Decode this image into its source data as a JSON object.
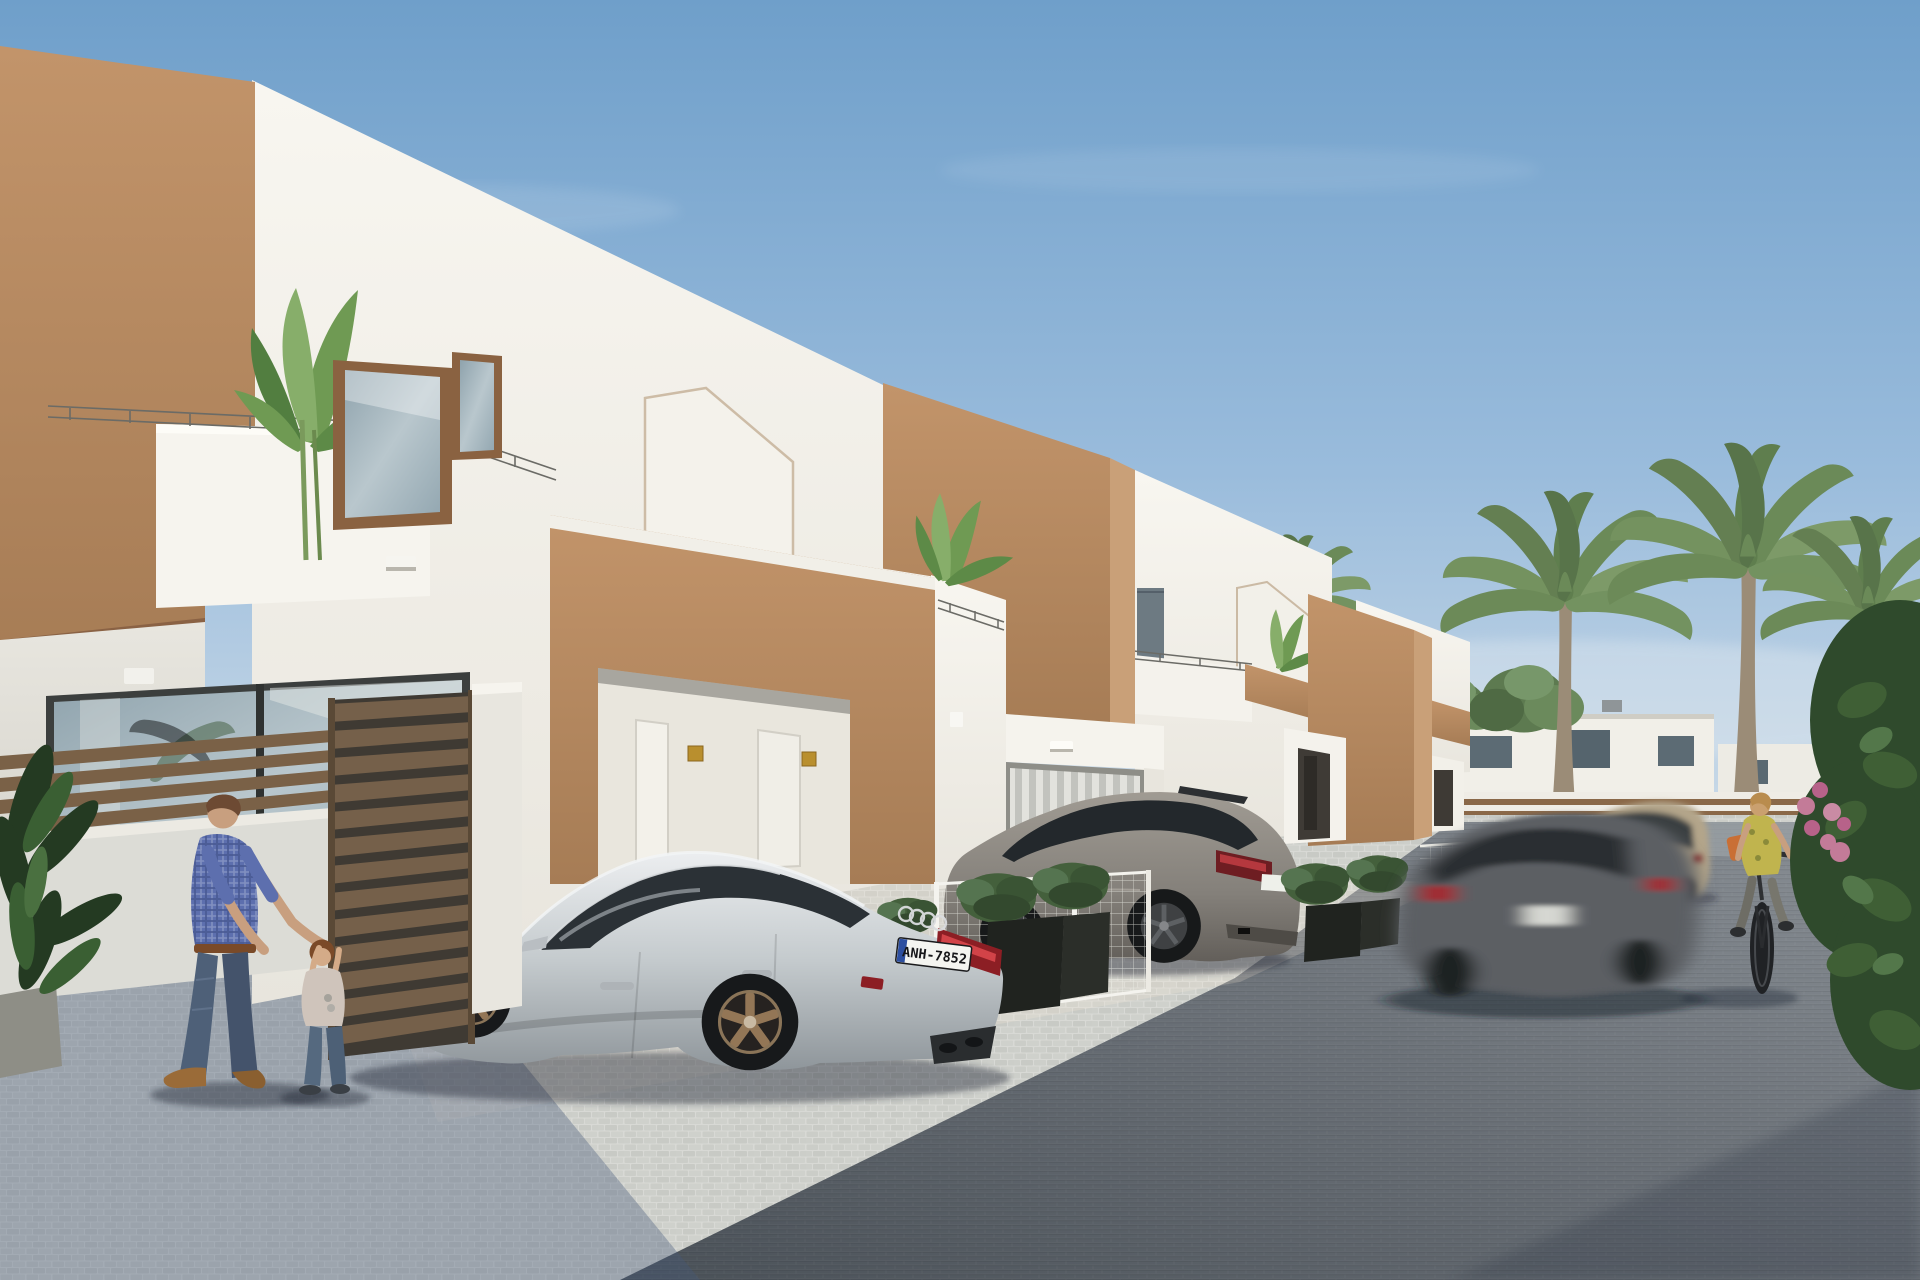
{
  "meta": {
    "title": "New-build Mediterranean villas — exterior street 3D render",
    "type": "photorealistic architectural visualization",
    "time_of_day": "daytime, clear blue sky"
  },
  "palette": {
    "sky-top": "#6f9fca",
    "sky-mid": "#9abcdc",
    "sky-horizon": "#cfdde9",
    "wall-white": "#f6f4ee",
    "wall-white-dim": "#e9e6de",
    "wall-shade": "#dcdad2",
    "brown": "#b78a61",
    "brown-light": "#c9a078",
    "brown-dark": "#9c7351",
    "brown-recess": "#8a6244",
    "frame-brown": "#8a6241",
    "glass-blue": "#a9bfcc",
    "glass-dark": "#2e3438",
    "railing": "#6b6b66",
    "fence-brown": "#7a6147",
    "gate-brown": "#6e5841",
    "cobble": "#d2d3d0",
    "cobble-shade": "#8fa0b5",
    "asphalt": "#6a7076",
    "asphalt-dark": "#4d545c",
    "asphalt-light": "#9aa0a4",
    "planter": "#20231f",
    "shrub-green": "#44603c",
    "palm-green": "#7d9a68",
    "palm-trunk": "#9b8c77",
    "foliage-dark": "#2f4a2c",
    "flower-pink": "#c37b98",
    "audi-silver": "#ccd1d4",
    "audi-shadow": "#9aa1a7",
    "wheel-bronze": "#937656",
    "tire": "#17191b",
    "tail-red": "#8c1e24",
    "tail-red-bright": "#cf4348",
    "mazda-gray": "#8b8781",
    "suv-beige": "#b3a58a",
    "blur-gray": "#5b5f63",
    "plate-bg": "#f4f4f0",
    "plate-text": "#17171a",
    "skin": "#c89f7f",
    "hair-brown": "#6d4a33",
    "shirt-plaid-blue": "#5d6fae",
    "jeans": "#4e6078",
    "shoe-brown": "#9a6b38",
    "child-shirt": "#cfc4bb",
    "cyclist-top": "#c0b44e",
    "cyclist-pants": "#6e6d65",
    "bag-orange": "#c96f35",
    "lamp-white": "#fdfcf8",
    "plaque-gold": "#b98f2e"
  },
  "scene": {
    "setting": "street of new-build two-storey white villas with tan-brown accent volumes, palm trees, parked cars and people",
    "villas": {
      "count": 4,
      "features": [
        "white stucco volumes",
        "tan-brown accent boxes",
        "house-shaped outline relief on facade",
        "roof terraces with thin wire railings",
        "banana plants on balconies",
        "recessed entrance porches",
        "small gold door plaques",
        "large sliding glass doors"
      ]
    },
    "cars": {
      "audi": {
        "type": "silver sportback, rear three-quarter view, bronze wheels",
        "license_plate": "ANH-7852",
        "badges": [
          "audi-rings",
          "RS"
        ]
      },
      "suv": {
        "type": "grey SUV parked behind wire-mesh garden fence"
      },
      "moving_car": {
        "type": "grey hatchback driving, motion-blurred"
      },
      "beige_suv": {
        "type": "beige crossover parked further down the road"
      }
    },
    "people": [
      {
        "label": "man in blue plaid shirt and jeans playing with a toddler"
      },
      {
        "label": "toddler in light shirt and jeans reaching up"
      },
      {
        "label": "woman in yellow top riding a bicycle"
      }
    ],
    "vegetation": [
      "balcony banana plants",
      "three tall palm trees",
      "background trees",
      "boxed shrubs in black planters",
      "dark green foreground plant",
      "pink bougainvillea"
    ],
    "ground": [
      "light cobblestone parking apron",
      "dark block-paved street",
      "long building shadows bottom-left"
    ]
  }
}
